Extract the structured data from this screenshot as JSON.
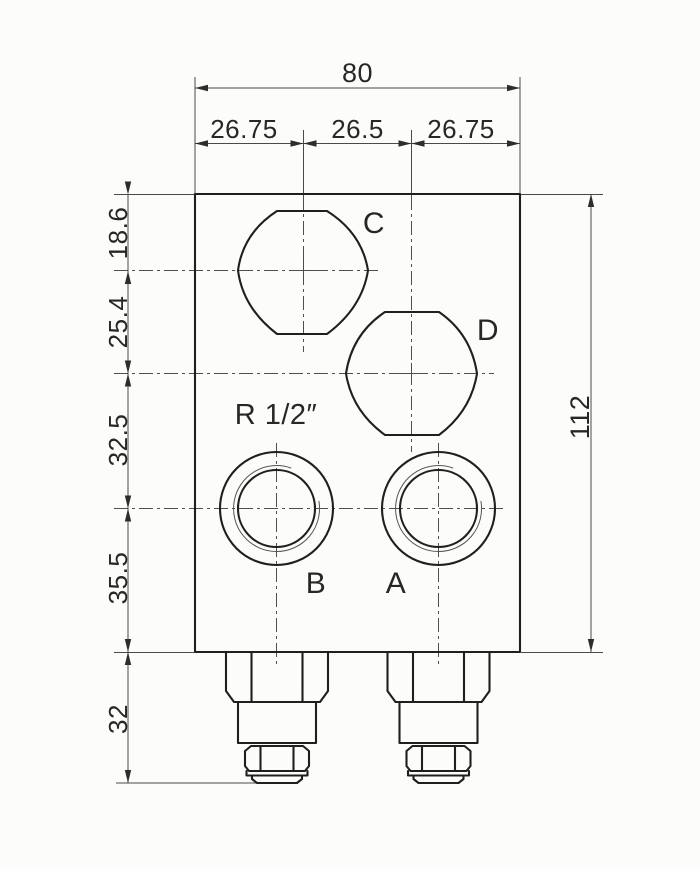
{
  "dimensions": {
    "top_overall": "80",
    "top_segments": [
      "26.75",
      "26.5",
      "26.75"
    ],
    "left_segments": [
      "18.6",
      "25.4",
      "32.5",
      "35.5",
      "32"
    ],
    "right_overall": "112"
  },
  "labels": {
    "thread": "R 1/2″",
    "port_c": "C",
    "port_d": "D",
    "port_b": "B",
    "port_a": "A"
  },
  "colors": {
    "line_bold": "#1f1f1f",
    "line_thin": "#4a4a4a",
    "text": "#272727",
    "paper": "#fcfcfa"
  }
}
